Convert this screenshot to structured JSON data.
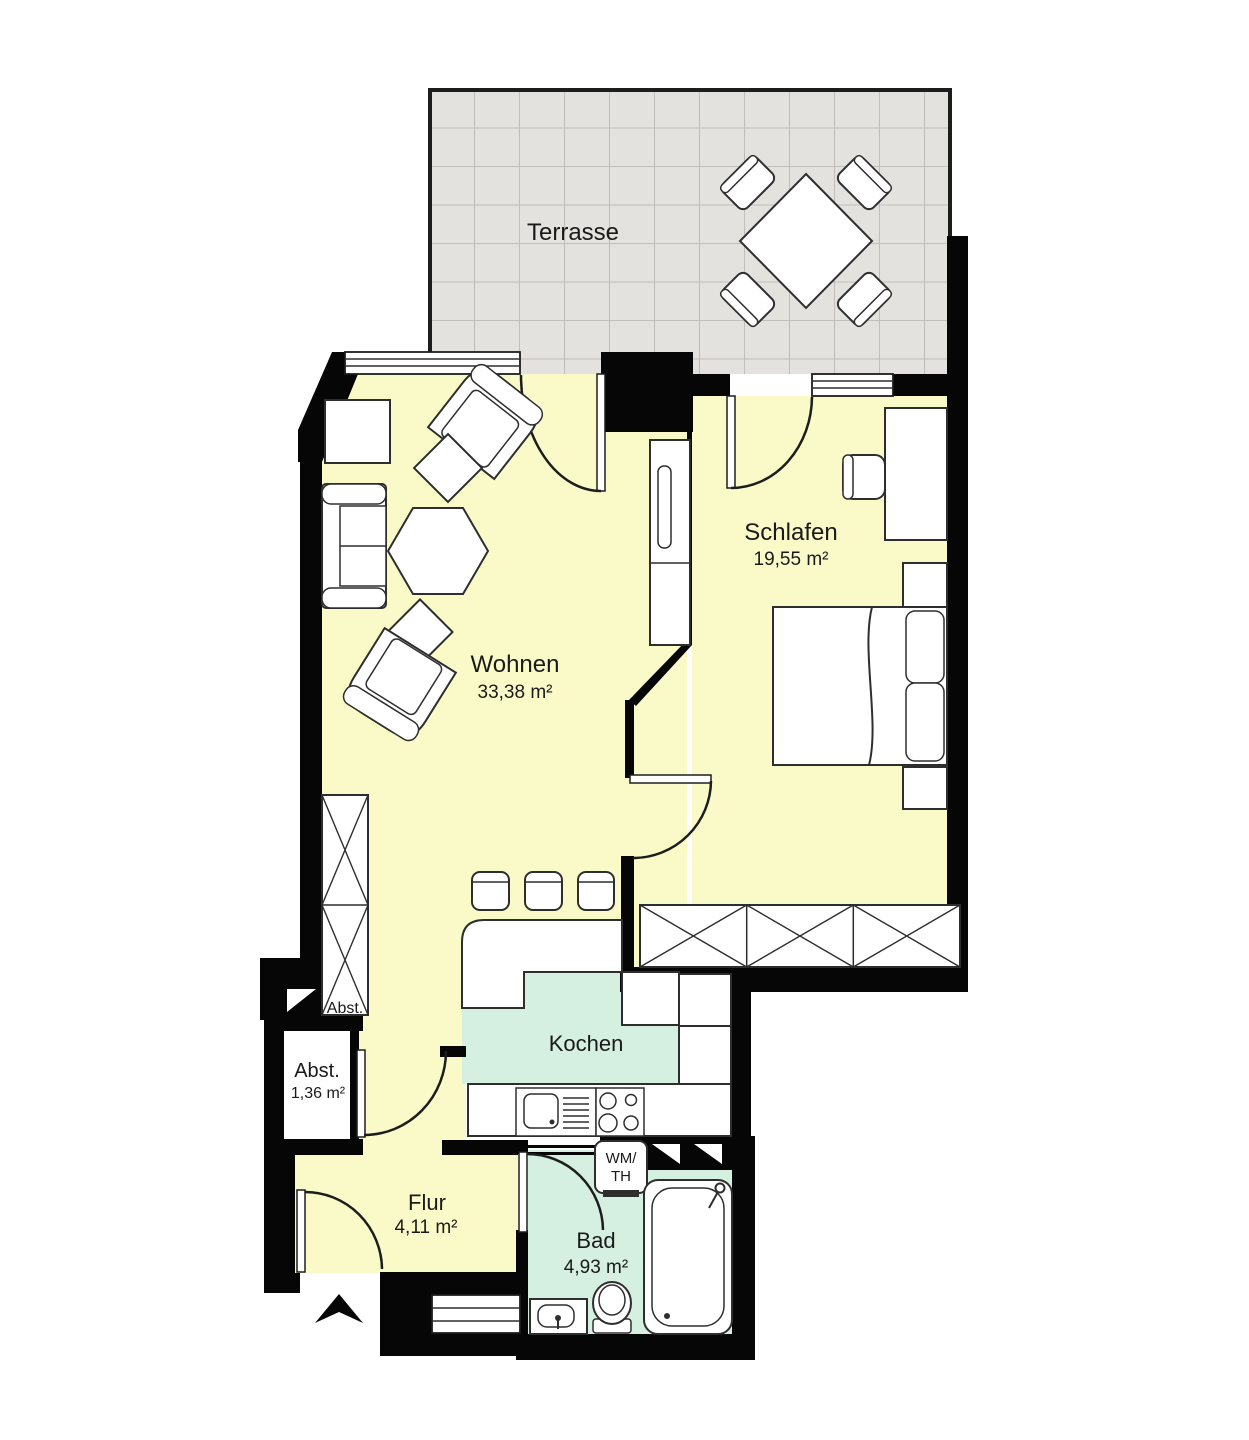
{
  "plan_type": "apartment-floor-plan",
  "rooms": {
    "terrasse": {
      "name": "Terrasse"
    },
    "wohnen": {
      "name": "Wohnen",
      "area": "33,38 m²"
    },
    "schlafen": {
      "name": "Schlafen",
      "area": "19,55 m²"
    },
    "kochen": {
      "name": "Kochen"
    },
    "abstellraum": {
      "name": "Abst.",
      "area": "1,36 m²"
    },
    "abstellraum_closet": {
      "name": "Abst."
    },
    "flur": {
      "name": "Flur",
      "area": "4,11 m²"
    },
    "bad": {
      "name": "Bad",
      "area": "4,93 m²"
    }
  },
  "appliances": {
    "washer_dryer": {
      "line1": "WM/",
      "line2": "TH"
    }
  },
  "colors": {
    "wall": "#060606",
    "floor_living": "#fafac8",
    "floor_wet": "#d5efe0",
    "terrace_tile": "#e4e2de",
    "tile_line": "#c1beba",
    "furniture_stroke": "#2e2e2e",
    "text": "#1a1a1a"
  }
}
